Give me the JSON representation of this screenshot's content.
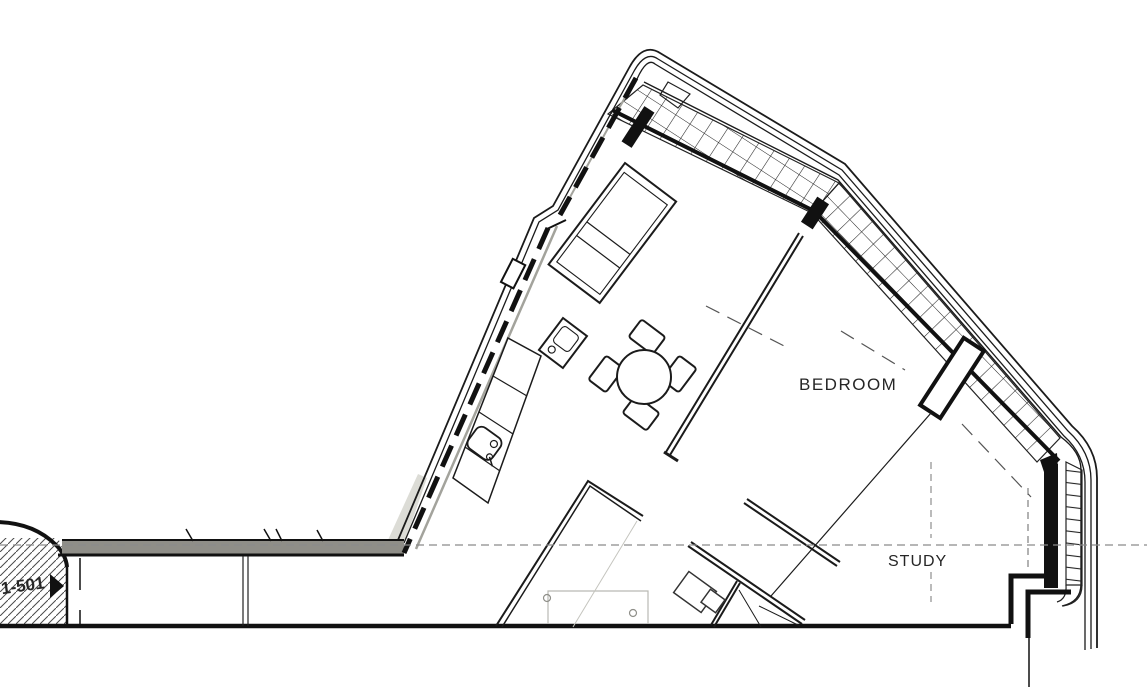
{
  "plan": {
    "type": "architectural-floor-plan",
    "rooms": [
      {
        "id": "bedroom",
        "label": "BEDROOM"
      },
      {
        "id": "study",
        "label": "STUDY"
      }
    ],
    "marker": {
      "label": "1-501",
      "icon": "right-arrow"
    },
    "colors": {
      "ink": "#1b1b1b",
      "balcony_edge": "#8f8e88",
      "junction": "#dcdcd6",
      "dashed": "#8a8a8a",
      "light": "#b9b9b3"
    },
    "elements": [
      "exterior-envelope",
      "glazed-mullion-band",
      "wall-piers",
      "entry-hatch-wall",
      "balcony-edge-band",
      "kitchen-counter",
      "sink",
      "bed",
      "nightstand",
      "dining-table",
      "chairs",
      "desk",
      "office-chair"
    ]
  }
}
